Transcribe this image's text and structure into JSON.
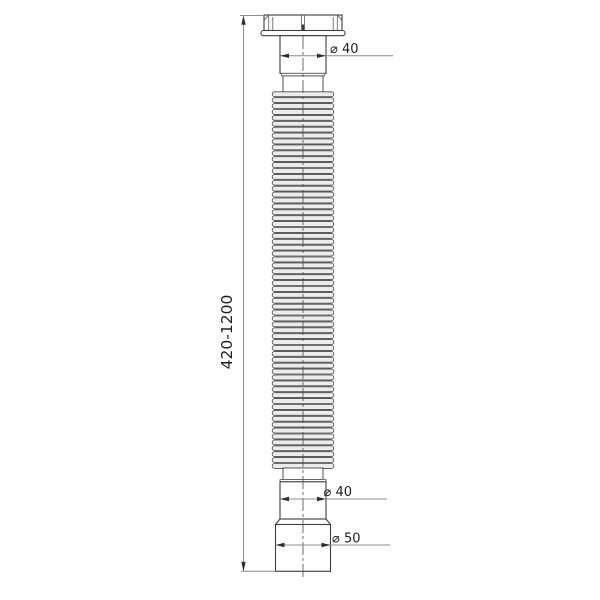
{
  "dimensions": {
    "length_range": "420-1200",
    "top_diameter": "⌀ 40",
    "bottom_diameter": "⌀ 40",
    "outlet_diameter": "⌀ 50"
  },
  "colors": {
    "background": "#ffffff",
    "part_outline": "#3d3d3d",
    "thin_line": "#5a5a5a",
    "dimension_line": "#8c8c8c",
    "arrow": "#2e2e2e",
    "rib_fill": "#ececec",
    "valley_fill": "#dcdcdc",
    "text": "#1f1f1f"
  }
}
